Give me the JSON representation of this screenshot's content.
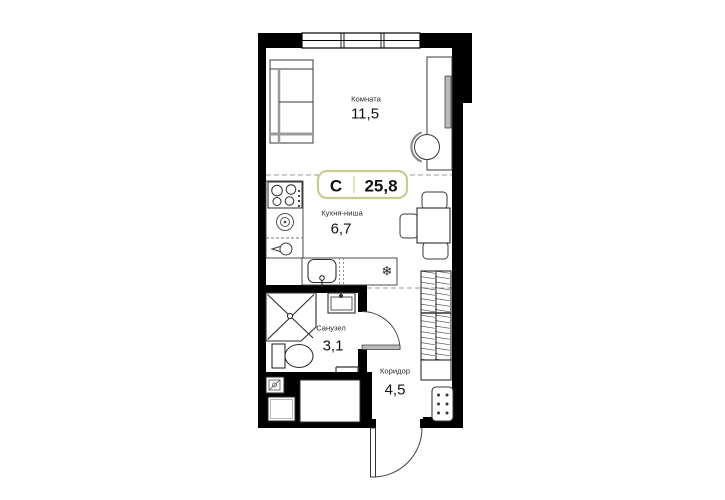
{
  "plan": {
    "badge": {
      "type_label": "С",
      "total_area": "25,8"
    },
    "rooms": [
      {
        "id": "living-room",
        "name": "Комната",
        "area": "11,5"
      },
      {
        "id": "kitchen",
        "name": "Кухня-ниша",
        "area": "6,7"
      },
      {
        "id": "bathroom",
        "name": "Санузел",
        "area": "3,1"
      },
      {
        "id": "corridor",
        "name": "Коридор",
        "area": "4,5"
      }
    ],
    "symbols": {
      "fridge": "❄"
    },
    "colors": {
      "wall": "#000000",
      "badge_border": "#c9cc8f",
      "badge_divider": "#e3e6b4",
      "fixture_stroke": "#3a3a3a",
      "zone_dash": "#999999"
    }
  }
}
